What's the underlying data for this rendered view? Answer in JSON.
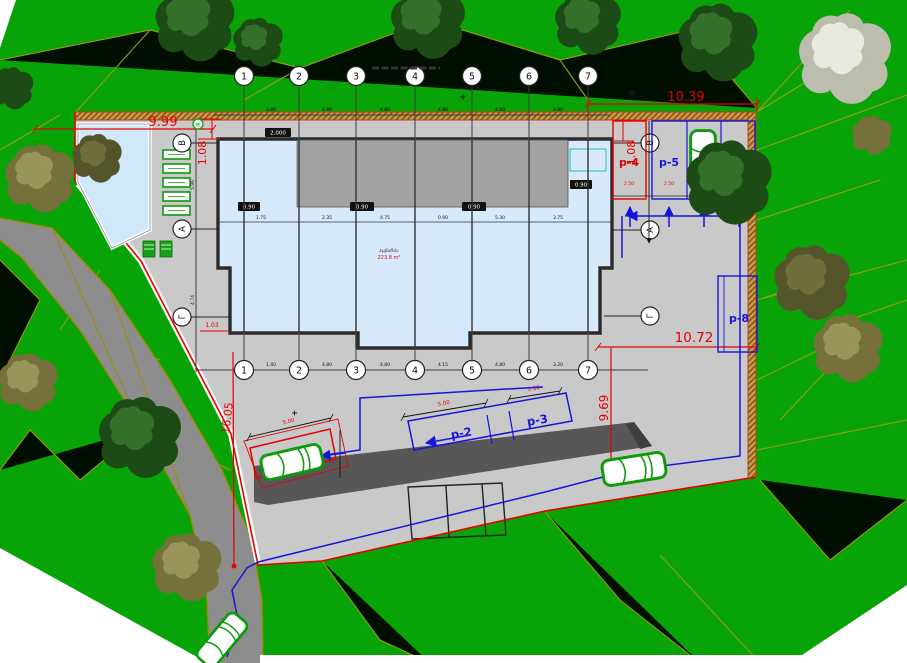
{
  "title": "site-plan-drawing",
  "colors": {
    "grass": "#07a307",
    "survey_line": "#ab9c12",
    "plaza": "#c9c9c9",
    "road": "#8d8d8d",
    "retaining": "#575757",
    "building_fill": "#d6eafb",
    "pool_fill": "#cfe8fa",
    "roof": "#a2a2a2",
    "boundary_hatch": "#cc9a4e",
    "dim_red": "#e60000",
    "route_blue": "#1616d8",
    "car_green": "#0b9b0b"
  },
  "axes": {
    "cols": [
      "1",
      "2",
      "3",
      "4",
      "5",
      "6",
      "7"
    ],
    "rows": [
      "Β",
      "Α",
      "Γ"
    ]
  },
  "dims": {
    "w999": "9.99",
    "h108_left": "1.08",
    "w1039": "10.39",
    "h108_right": "1.08",
    "w1072": "10.72",
    "h969": "9.69",
    "h1605": "16.05",
    "d103": "1.03"
  },
  "chains": {
    "top": [
      "3.80",
      "4.80",
      "4.80",
      "4.80",
      "4.80",
      "4.80"
    ],
    "bottom": [
      "1.40",
      "4.80",
      "4.80",
      "4.15",
      "4.80",
      "3.20"
    ],
    "building": [
      "1.75",
      "2.35",
      "4.75",
      "0.90",
      "5.30",
      "3.75"
    ],
    "left": [
      "5.96",
      "4.74"
    ],
    "stall": "2.50",
    "p1": "5.00",
    "p2": "5.00",
    "p3": "2.50"
  },
  "parking": {
    "p1": "p-1",
    "p2": "p-2",
    "p3": "p-3",
    "p4": "p-4",
    "p5": "p-5",
    "p6": "p-6",
    "p7": "p-7",
    "p8": "p-8"
  },
  "building": {
    "note_top": "εμβαδόν",
    "note_bottom": "223.8 m²",
    "tags": [
      "2.000",
      "0.90",
      "0.90",
      "0.90",
      "0.90"
    ]
  }
}
